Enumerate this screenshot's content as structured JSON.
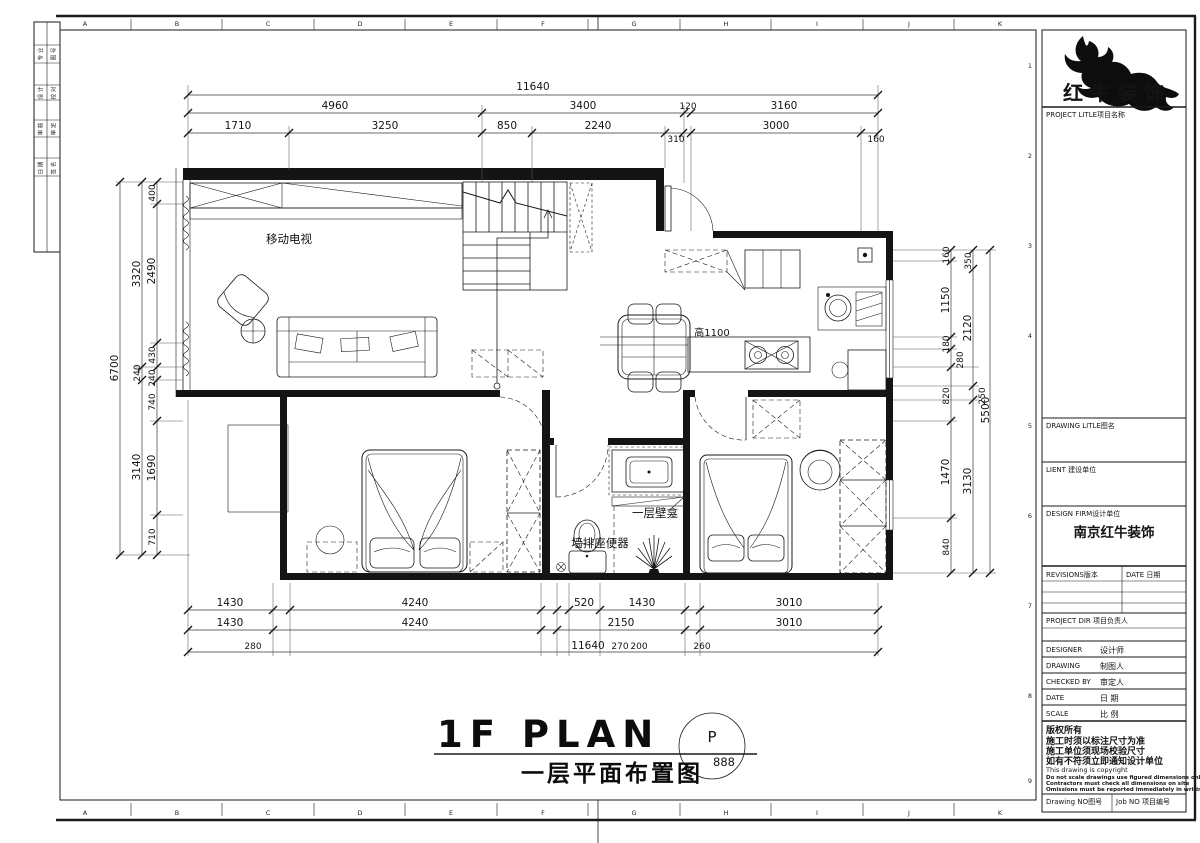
{
  "sheet": {
    "grid_letters": [
      "A",
      "B",
      "C",
      "D",
      "E",
      "F",
      "G",
      "H",
      "I",
      "J",
      "K"
    ],
    "grid_numbers": [
      "1",
      "2",
      "3",
      "4",
      "5",
      "6",
      "7",
      "8",
      "9"
    ]
  },
  "drawing_title": {
    "en": "1F PLAN",
    "zh": "一层平面布置图",
    "bubble_letter": "P",
    "bubble_number": "888"
  },
  "plan_labels": {
    "tv": "移动电视",
    "bar_height": "高1100",
    "niche": "一层壁龛",
    "toilet": "墙排座便器"
  },
  "dims": {
    "top": {
      "total": "11640",
      "row2": [
        "4960",
        "3400",
        "120",
        "3160"
      ],
      "row3": [
        "1710",
        "3250",
        "850",
        "2240",
        "310",
        "3000",
        "160"
      ]
    },
    "bottom": {
      "row1": [
        "1430",
        "4240",
        "520",
        "1430",
        "3010"
      ],
      "row2": [
        "1430",
        "4240",
        "2150",
        "3010"
      ],
      "small": [
        "280",
        "270",
        "200",
        "260"
      ],
      "total": "11640"
    },
    "left": {
      "total": "6700",
      "mid": [
        "3320",
        "240",
        "3140"
      ],
      "inner": [
        "400",
        "2490",
        "430",
        "240",
        "740",
        "1690",
        "710"
      ]
    },
    "right": {
      "total": "5500",
      "mid": [
        "350",
        "2120",
        "250",
        "3130"
      ],
      "inner": [
        "160",
        "1150",
        "180",
        "280",
        "820",
        "1470",
        "840"
      ]
    }
  },
  "titleblock": {
    "logo_text": "红牛装饰",
    "project_label": "PROJECT LITLE项目名称",
    "drawing_label": "DRAWING LITLE图名",
    "client_label": "LIENT 建设单位",
    "firm_label": "DESIGN FIRM设计单位",
    "firm_value": "南京红牛装饰",
    "revisions_label": "REVISIONS版本",
    "rev_date_label": "DATE 日期",
    "pd_label": "PROJECT DIR 项目负责人",
    "designer_label": "DESIGNER",
    "designer_zh": "设计师",
    "draftsman_label": "DRAWING",
    "draftsman_zh": "制图人",
    "checked_label": "CHECKED BY",
    "checked_zh": "审定人",
    "date_label": "DATE",
    "date_zh": "日 期",
    "scale_label": "SCALE",
    "scale_zh": "比 例",
    "copyright": [
      "版权所有",
      "施工时须以标注尺寸为准",
      "施工单位须现场校验尺寸",
      "如有不符须立即通知设计单位",
      "This drawing is copyright",
      "Do not scale drawings use figured dimensions only",
      "Contractors must check all dimensions on site",
      "Omissions must be reported immediately in writing"
    ],
    "drawing_no_label": "Drawing NO图号",
    "job_no_label": "Job NO 项目编号"
  },
  "signature_strip": {
    "cells": [
      [
        "专 业",
        "图 号"
      ],
      [
        "设 计",
        "校 对"
      ],
      [
        "审 核",
        "审 定"
      ],
      [
        "日 期",
        "签 名"
      ]
    ]
  }
}
